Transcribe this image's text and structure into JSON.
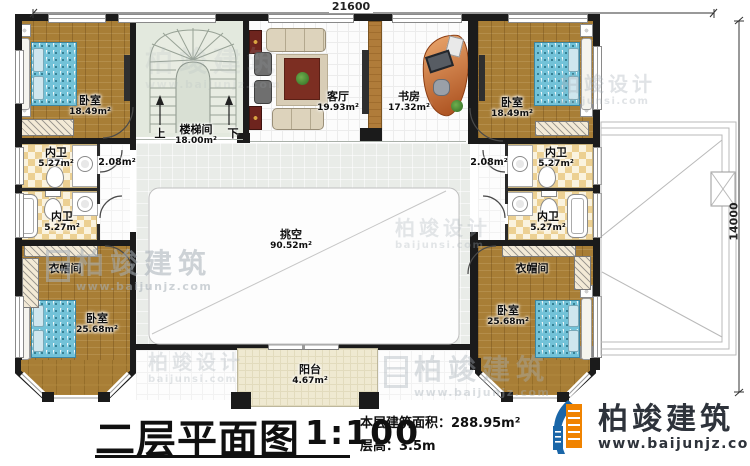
{
  "dimensions": {
    "width_top": "21600",
    "height_right": "14000"
  },
  "rooms": {
    "bedroom_tl": {
      "name": "卧室",
      "area": "18.49m²"
    },
    "bedroom_tr": {
      "name": "卧室",
      "area": "18.49m²"
    },
    "bedroom_bl": {
      "name": "卧室",
      "area": "25.68m²"
    },
    "bedroom_br": {
      "name": "卧室",
      "area": "25.68m²"
    },
    "stairwell": {
      "name": "楼梯间",
      "area": "18.00m²",
      "up": "上",
      "down": "下"
    },
    "living": {
      "name": "客厅",
      "area": "19.93m²"
    },
    "study": {
      "name": "书房",
      "area": "17.32m²"
    },
    "bath_l1": {
      "name": "内卫",
      "area": "5.27m²"
    },
    "bath_l2": {
      "name": "内卫",
      "area": "5.27m²"
    },
    "bath_r1": {
      "name": "内卫",
      "area": "5.27m²"
    },
    "bath_r2": {
      "name": "内卫",
      "area": "5.27m²"
    },
    "cloak_l": {
      "name": "衣帽间"
    },
    "cloak_r": {
      "name": "衣帽间"
    },
    "void": {
      "name": "挑空",
      "area": "90.52m²"
    },
    "balcony": {
      "name": "阳台",
      "area": "4.67m²"
    },
    "corridor_l": {
      "area": "2.08m²"
    },
    "corridor_r": {
      "area": "2.08m²"
    }
  },
  "titleblock": {
    "title": "二层平面图",
    "scale": "1:100",
    "area_label": "本层建筑面积：288.95m²",
    "height_label": "层高：3.5m"
  },
  "brand": {
    "name": "柏竣建筑",
    "site": "www.baijunjz.com",
    "color_blue": "#1a66a8",
    "color_orange": "#f08300"
  },
  "watermarks": {
    "w1": {
      "line1": "柏竣建筑",
      "line2": "www.baijunjz.com"
    },
    "w2": {
      "line1": "柏竣设计",
      "line2": "baijunsi.com"
    },
    "w3": {
      "line1": "柏竣建筑",
      "line2": "www.baijunjz.com"
    },
    "w4": {
      "line1": "柏竣设计",
      "line2": "baijunsi.com"
    },
    "w5": {
      "line1": "柏竣设计",
      "line2": "baijunsi.com"
    },
    "w6": {
      "line1": "柏竣建筑",
      "line2": "www.baijunjz.com"
    }
  }
}
